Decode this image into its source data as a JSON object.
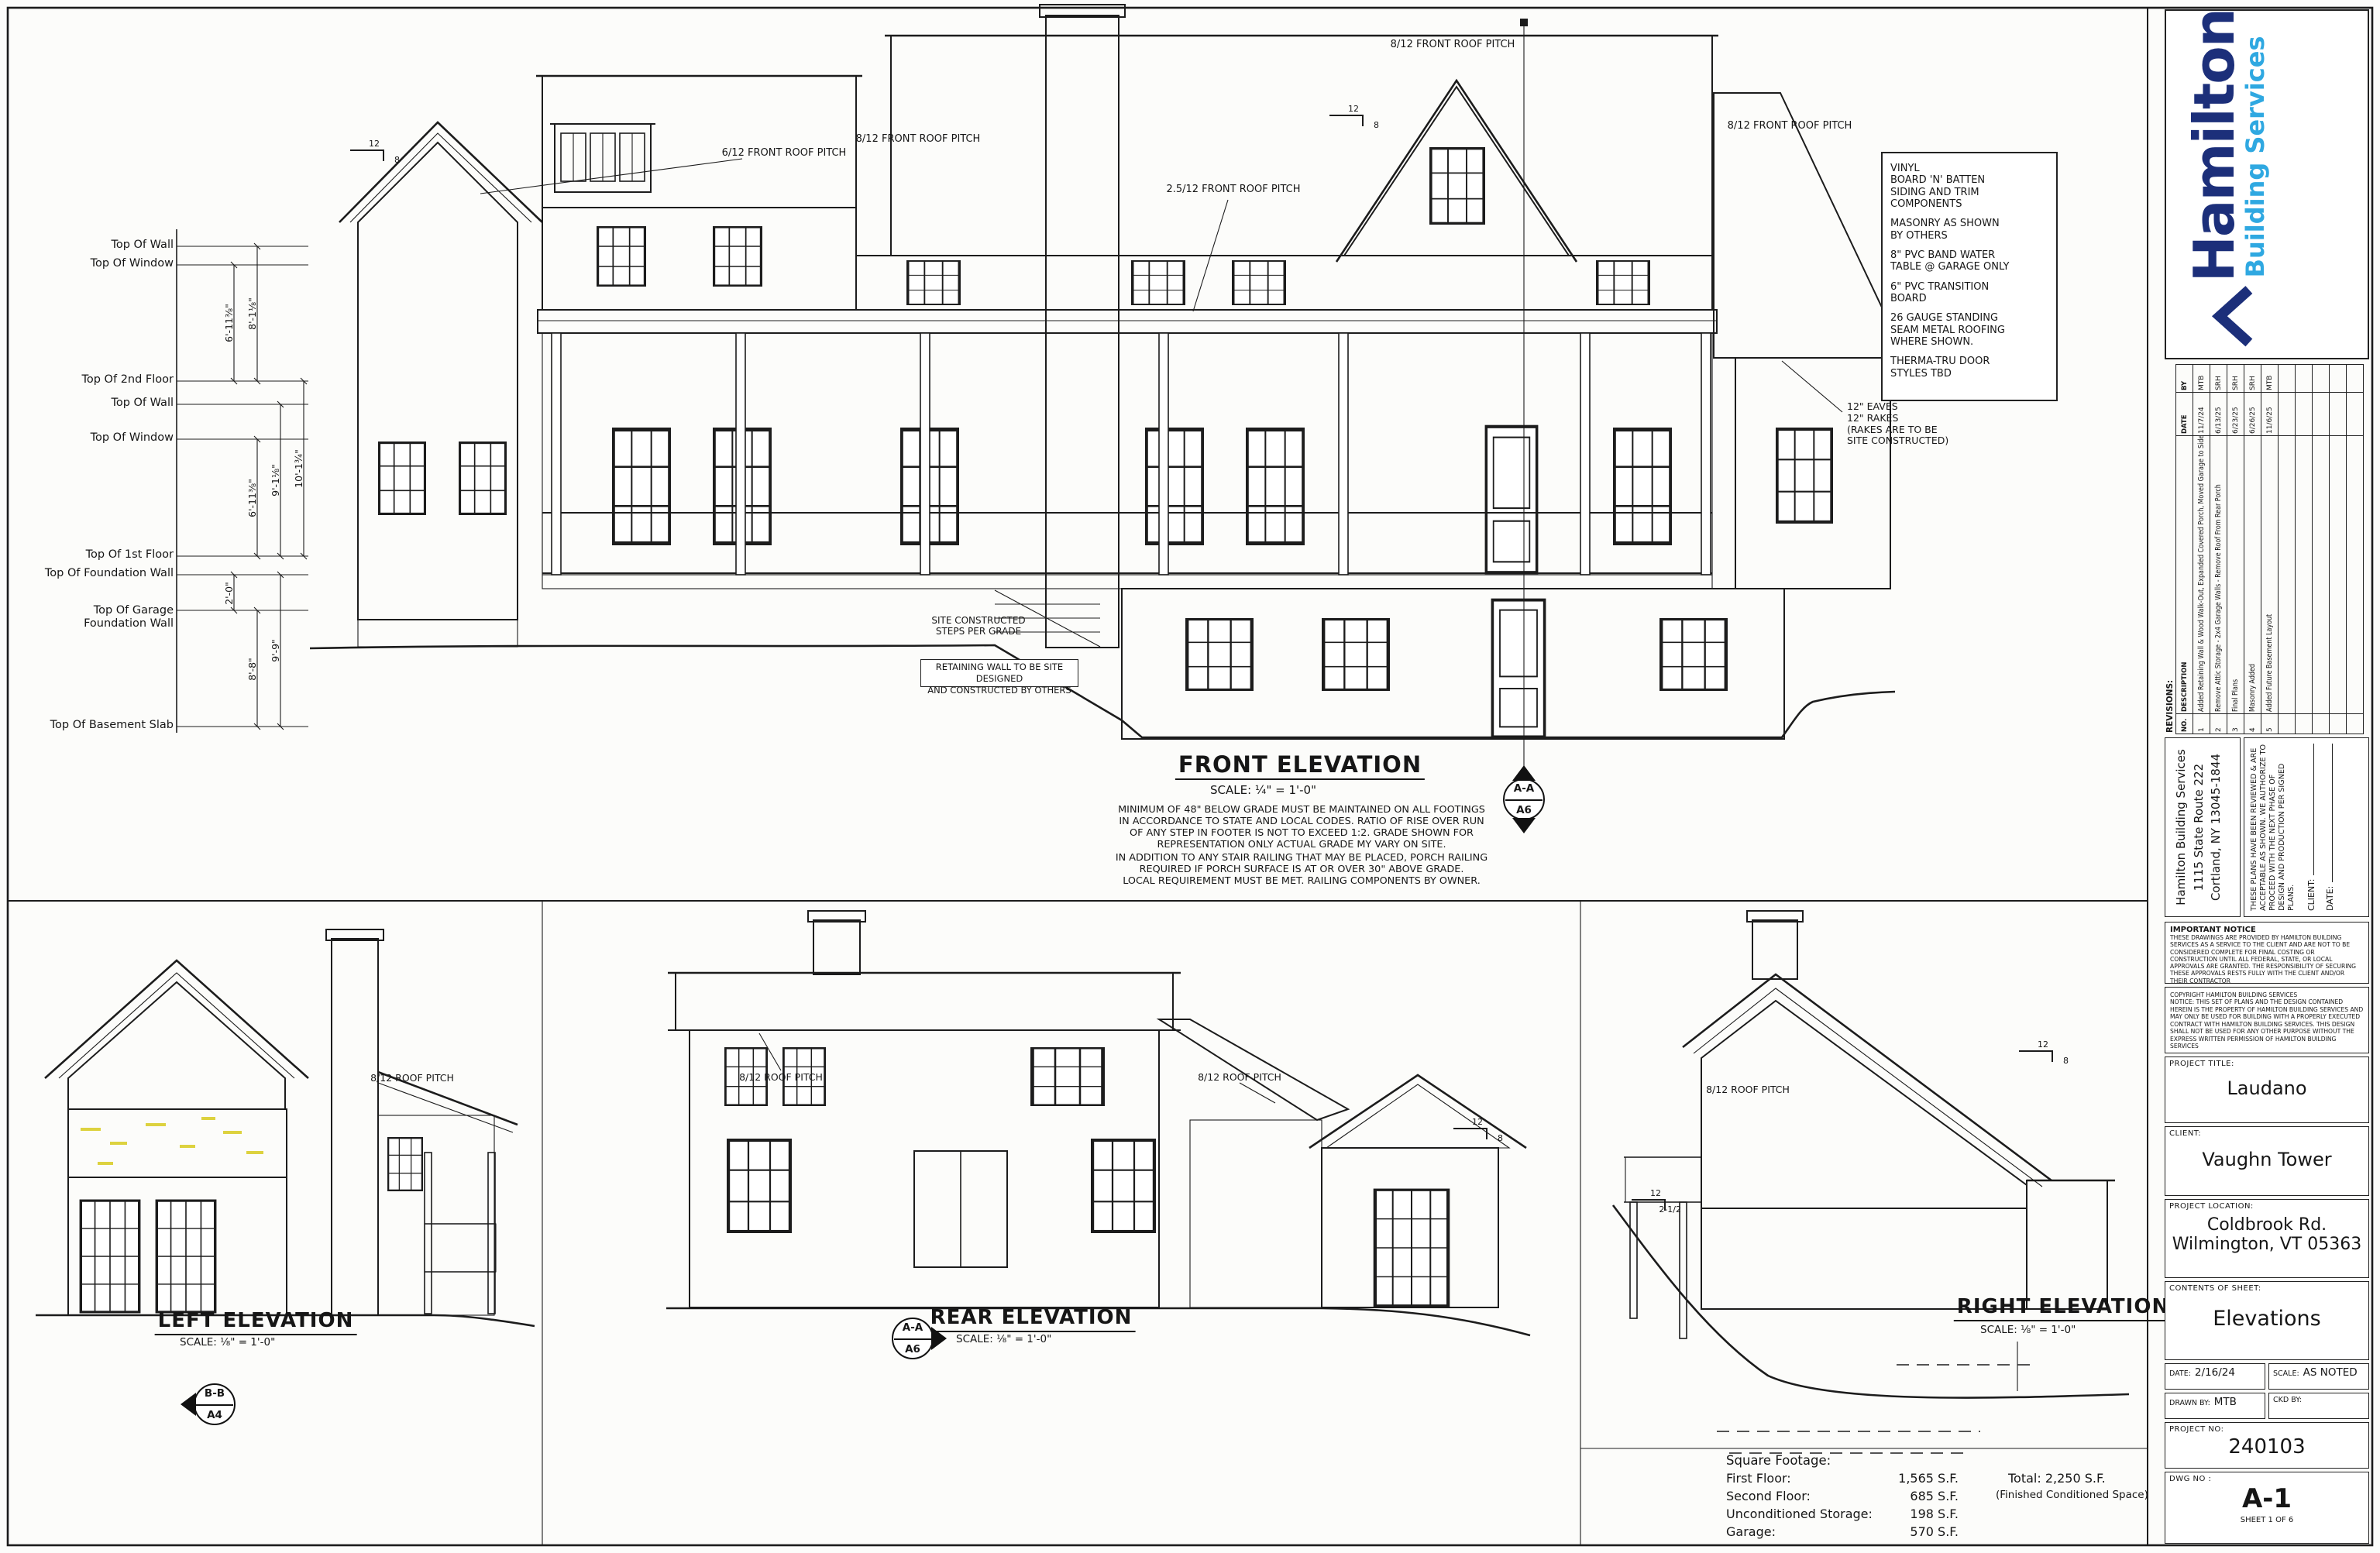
{
  "colors": {
    "line": "#1c1c1c",
    "logo_navy": "#1c2f7a",
    "logo_blue": "#2fa8e1",
    "highlight_yellow": "#ddd23f"
  },
  "datum": {
    "labels": [
      "Top Of Wall",
      "Top Of Window",
      "Top Of 2nd Floor",
      "Top Of Wall",
      "Top Of Window",
      "Top Of 1st Floor",
      "Top Of Foundation Wall",
      "Top Of Garage\nFoundation Wall",
      "Top Of Basement Slab"
    ],
    "dims": [
      "6'-11⅜\"",
      "2'-0\"",
      "8'-1⅛\"",
      "6'-11⅜\"",
      "8'-8\"",
      "9'-1⅛\"",
      "9'-9\"",
      "10'-1¾\""
    ]
  },
  "front": {
    "title": "FRONT ELEVATION",
    "scale": "SCALE: ¼\" = 1'-0\"",
    "pitch_top": "8/12 FRONT ROOF PITCH",
    "pitch_right": "8/12 FRONT ROOF PITCH",
    "pitch_left": "8/12 FRONT ROOF PITCH",
    "pitch_6": "6/12 FRONT ROOF PITCH",
    "pitch_25": "2.5/12 FRONT ROOF PITCH",
    "eaves_note": "12\" EAVES\n12\" RAKES\n(RAKES ARE TO BE\nSITE CONSTRUCTED)",
    "materials": [
      "VINYL\nBOARD 'N' BATTEN\nSIDING AND TRIM\nCOMPONENTS",
      "MASONRY AS SHOWN\nBY OTHERS",
      "8\" PVC BAND WATER\nTABLE @ GARAGE ONLY",
      "6\" PVC TRANSITION\nBOARD",
      "26 GAUGE STANDING\nSEAM METAL ROOFING\nWHERE SHOWN.",
      "THERMA-TRU DOOR\nSTYLES TBD"
    ],
    "steps_note": "SITE CONSTRUCTED\nSTEPS PER GRADE",
    "retaining_note": "RETAINING WALL TO BE SITE DESIGNED\nAND CONSTRUCTED BY OTHERS",
    "note1": "MINIMUM OF 48\" BELOW GRADE MUST BE MAINTAINED ON ALL FOOTINGS\nIN ACCORDANCE TO STATE AND LOCAL CODES.  RATIO OF RISE OVER RUN\nOF ANY STEP IN FOOTER IS NOT TO EXCEED 1:2.  GRADE SHOWN FOR\nREPRESENTATION ONLY ACTUAL GRADE MY VARY ON SITE.",
    "note2": "IN ADDITION TO ANY STAIR RAILING THAT MAY BE PLACED, PORCH RAILING\nREQUIRED IF PORCH SURFACE IS AT OR OVER 30\" ABOVE GRADE.\nLOCAL REQUIREMENT MUST BE MET.  RAILING COMPONENTS BY OWNER.",
    "marker_top": "A-A",
    "marker_bot": "A6"
  },
  "left_elev": {
    "title": "LEFT ELEVATION",
    "scale": "SCALE: ⅛\" = 1'-0\"",
    "pitch": "8/12 ROOF PITCH",
    "marker_top": "B-B",
    "marker_bot": "A4"
  },
  "rear_elev": {
    "title": "REAR ELEVATION",
    "scale": "SCALE: ⅛\" = 1'-0\"",
    "pitch1": "8/12 ROOF PITCH",
    "pitch2": "8/12 ROOF PITCH",
    "marker_top": "A-A",
    "marker_bot": "A6"
  },
  "right_elev": {
    "title": "RIGHT ELEVATION",
    "scale": "SCALE: ⅛\" = 1'-0\"",
    "pitch": "8/12 ROOF PITCH"
  },
  "pitch_marks": [
    {
      "run": "12",
      "rise": "8"
    },
    {
      "run": "12",
      "rise": "8"
    },
    {
      "run": "12",
      "rise": "8"
    },
    {
      "run": "12",
      "rise": "8"
    },
    {
      "run": "12",
      "rise": "2-1/2"
    }
  ],
  "sqft": {
    "heading": "Square Footage:",
    "rows": [
      {
        "label": "First Floor:",
        "value": "1,565 S.F."
      },
      {
        "label": "Second Floor:",
        "value": "685 S.F."
      },
      {
        "label": "Unconditioned Storage:",
        "value": "198 S.F."
      },
      {
        "label": "Garage:",
        "value": "570 S.F."
      }
    ],
    "total": "Total:  2,250 S.F.",
    "total_note": "(Finished Conditioned Space)"
  },
  "titleblock": {
    "logo": {
      "name": "Hamilton",
      "tagline": "Building Services"
    },
    "revisions": {
      "title": "REVISIONS:",
      "headers": {
        "no": "NO.",
        "desc": "DESCRIPTION",
        "date": "DATE",
        "by": "BY"
      },
      "rows": [
        {
          "no": "1",
          "desc": "Added Retaining Wall & Wood Walk-Out, Expanded Covered Porch, Moved Garage to Side, Misc. Rev.",
          "date": "11/7/24",
          "by": "MTB"
        },
        {
          "no": "2",
          "desc": "Remove Attic Storage - 2x4 Garage Walls - Remove Roof From Rear Porch",
          "date": "6/13/25",
          "by": "SRH"
        },
        {
          "no": "3",
          "desc": "Final Plans",
          "date": "6/23/25",
          "by": "SRH"
        },
        {
          "no": "4",
          "desc": "Masonry Added",
          "date": "6/26/25",
          "by": "SRH"
        },
        {
          "no": "5",
          "desc": "Added Future Basement Layout",
          "date": "11/6/25",
          "by": "MTB"
        }
      ]
    },
    "address": "Hamilton Building Services\n1115 State Route 222\nCortland, NY 13045-1844",
    "approval": {
      "text": "THESE PLANS HAVE BEEN REVIEWED & ARE ACCEPTABLE AS SHOWN.  WE AUTHORIZE TO PROCEED WITH THE NEXT PHASE OF DESIGN AND PRODUCTION PER SIGNED PLANS.",
      "client_label": "CLIENT:",
      "date_label": "DATE:"
    },
    "important_notice": {
      "title": "IMPORTANT NOTICE",
      "text": "THESE DRAWINGS ARE PROVIDED BY HAMILTON BUILDING SERVICES AS A SERVICE TO THE CLIENT AND ARE NOT TO BE CONSIDERED COMPLETE FOR FINAL COSTING OR CONSTRUCTION UNTIL ALL FEDERAL, STATE, OR LOCAL APPROVALS ARE GRANTED.  THE RESPONSIBILITY OF SECURING THESE APPROVALS RESTS FULLY WITH THE CLIENT AND/OR THEIR CONTRACTOR"
    },
    "copyright": {
      "text": "COPYRIGHT HAMILTON BUILDING SERVICES\nNOTICE: THIS SET OF PLANS AND THE DESIGN CONTAINED HEREIN IS THE PROPERTY OF HAMILTON BUILDING SERVICES AND MAY ONLY BE USED FOR BUILDING WITH A PROPERLY EXECUTED CONTRACT WITH HAMILTON BUILDING SERVICES. THIS DESIGN SHALL NOT BE USED FOR ANY OTHER PURPOSE WITHOUT THE EXPRESS WRITTEN PERMISSION OF HAMILTON BUILDING SERVICES"
    },
    "fields": {
      "project_title_label": "PROJECT TITLE:",
      "project_title": "Laudano",
      "client_label": "CLIENT:",
      "client": "Vaughn Tower",
      "location_label": "PROJECT LOCATION:",
      "location": "Coldbrook Rd.\nWilmington, VT 05363",
      "contents_label": "CONTENTS OF SHEET:",
      "contents": "Elevations",
      "date_label": "DATE:",
      "date": "2/16/24",
      "scale_label": "SCALE:",
      "scale": "AS NOTED",
      "drawn_label": "DRAWN BY:",
      "drawn": "MTB",
      "ckd_label": "CKD BY:",
      "ckd": "",
      "project_no_label": "PROJECT NO:",
      "project_no": "240103",
      "dwg_label": "DWG   NO :",
      "dwg_no": "A-1",
      "sheet": "SHEET 1 OF 6"
    }
  }
}
